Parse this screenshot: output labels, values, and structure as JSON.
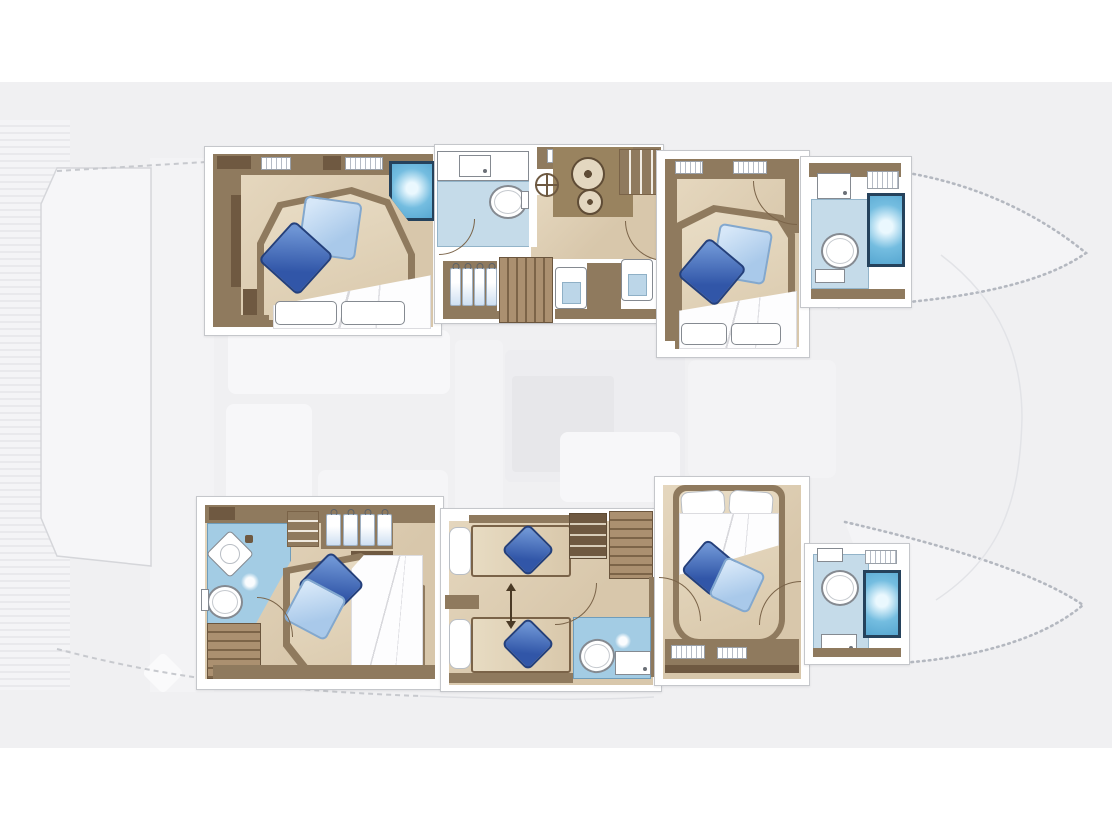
{
  "meta": {
    "title": "Catamaran lower-deck floor plan - six cabin layout",
    "type": "yacht-interior-floor-plan"
  },
  "colors": {
    "band": "#f0f0f2",
    "frameLine": "#c5c7cb",
    "wood": "#8f7a5e",
    "woodDark": "#6f5941",
    "floor": "#d8c7ab",
    "floorLight": "#e5d7be",
    "bath": "#c5dbe9",
    "bathDeep": "#a3cce4",
    "shower": "#74bde0",
    "showerFrame": "#25425c",
    "pillowDark": "#3156a8",
    "pillowDarkHi": "#6d94d4",
    "pillowLight": "#a9c9ea",
    "pillowLightHi": "#d6e7f8",
    "stairLight": "#ab9070",
    "stairDark": "#7c6448"
  },
  "deck": {
    "label": "Main deck shown faded: aft cockpit with teak planking, saloon furniture, foredeck between bow tips"
  },
  "hulls": {
    "port": {
      "label": "Port hull (top): aft double cabin with shower, corridor with WC, helm wheel, two-burner stove, stairs, wardrobes and vanities, forward double cabin with ensuite WC and shower",
      "cabins": [
        {
          "name": "port-aft-double",
          "features": [
            "double-bed",
            "dark-pillow",
            "light-pillow",
            "duvet",
            "shower-cubicle",
            "cabinets"
          ]
        },
        {
          "name": "port-corridor",
          "features": [
            "washbasin-counter",
            "toilet",
            "helm-wheel",
            "stove-two-burner",
            "cupboard",
            "hanging-wardrobe",
            "stairs",
            "vanity",
            "vanity"
          ]
        },
        {
          "name": "port-forward-double",
          "features": [
            "double-bed",
            "dark-pillow",
            "light-pillow",
            "duvet",
            "toilet",
            "washbasin",
            "shower-cubicle"
          ]
        }
      ]
    },
    "starboard": {
      "label": "Starboard hull (bottom): aft double cabin with corner basin ensuite and stairs, twin convertible cabin with WC, forward double cabin with ensuite WC and shower",
      "cabins": [
        {
          "name": "stbd-aft-double",
          "features": [
            "corner-washbasin",
            "toilet",
            "shower-head",
            "hanging-wardrobe",
            "shelves",
            "double-bed",
            "duvet",
            "stairs"
          ]
        },
        {
          "name": "stbd-twin-convertible",
          "features": [
            "single-bed",
            "single-bed",
            "conversion-arrow",
            "stairs",
            "cabinet",
            "toilet",
            "washbasin"
          ]
        },
        {
          "name": "stbd-forward-double",
          "features": [
            "double-bed",
            "white-pillows",
            "duvet",
            "dark-pillow",
            "light-pillow",
            "toilet",
            "washbasin",
            "shower-cubicle"
          ]
        }
      ]
    }
  }
}
